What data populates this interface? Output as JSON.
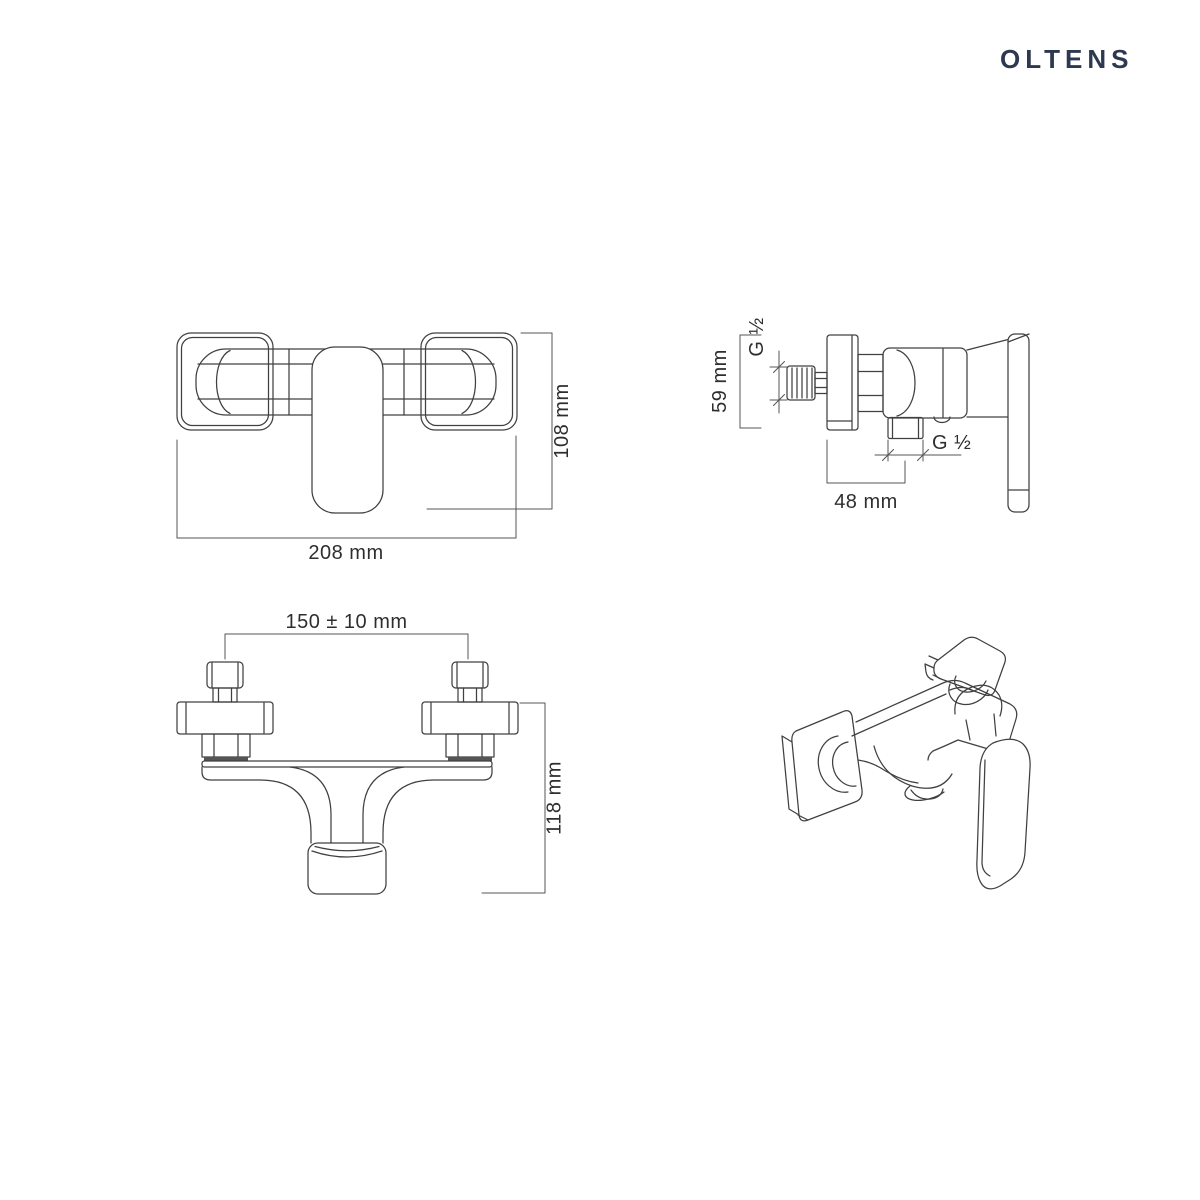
{
  "brand": {
    "name": "OLTENS"
  },
  "colors": {
    "logo": "#2c3950",
    "drawing_line": "#404040",
    "dimension_line": "#555555",
    "text": "#2e2e2e",
    "background": "#ffffff"
  },
  "views": {
    "front": {
      "label": "front-view",
      "width_dim": "208 mm",
      "height_dim": "108 mm"
    },
    "side": {
      "label": "side-view",
      "height_dim": "59 mm",
      "inlet_thread": "G ½",
      "outlet_thread": "G ½",
      "depth_dim": "48 mm"
    },
    "top": {
      "label": "top-view",
      "span_dim": "150 ± 10 mm",
      "depth_dim": "118 mm"
    },
    "isometric": {
      "label": "isometric-view"
    }
  }
}
